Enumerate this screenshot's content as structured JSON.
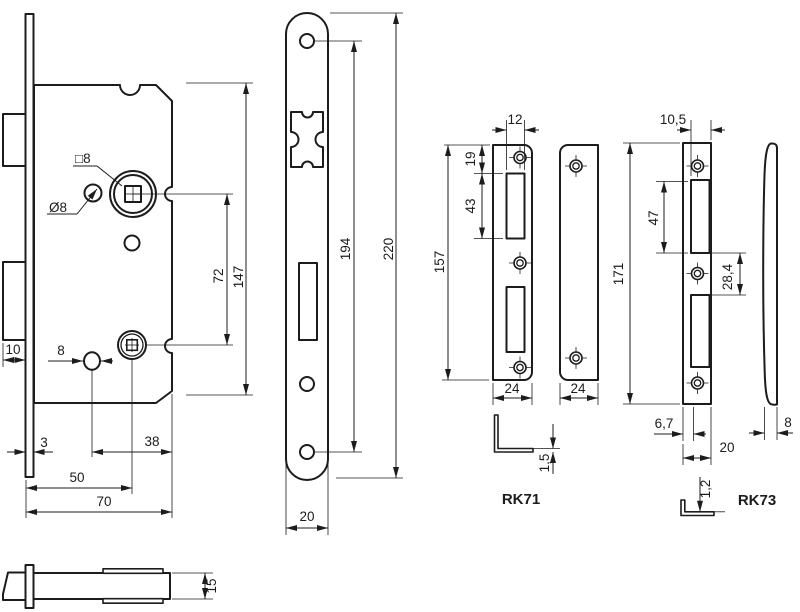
{
  "drawing": {
    "background": "#ffffff",
    "line_color": "#1c1c1c",
    "views": {
      "lock_body": {
        "labels": {
          "square_spindle": "□8",
          "follower_hole": "Ø8",
          "hole_dia": "8",
          "bolt_throw": "10",
          "faceplate_thickness": "3",
          "hole_to_back": "38",
          "backset": "50",
          "case_depth": "70",
          "centre_distance": "72",
          "case_height": "147"
        }
      },
      "lock_top": {
        "labels": {
          "case_thickness": "15"
        }
      },
      "faceplate": {
        "labels": {
          "screw_centres": "194",
          "length": "220",
          "width": "20"
        }
      },
      "rk71": {
        "title": "RK71",
        "labels": {
          "slot_width": "12",
          "top_to_slot": "19",
          "slot_length": "43",
          "length": "157",
          "width_front": "24",
          "width_side": "24",
          "thickness": "1,5"
        }
      },
      "rk73": {
        "title": "RK73",
        "labels": {
          "slot_width": "10,5",
          "slot_length": "47",
          "slot_gap": "28,4",
          "length": "171",
          "edge_to_slot": "6,7",
          "width": "20",
          "side_width": "8",
          "thickness": "1,2"
        }
      }
    }
  }
}
